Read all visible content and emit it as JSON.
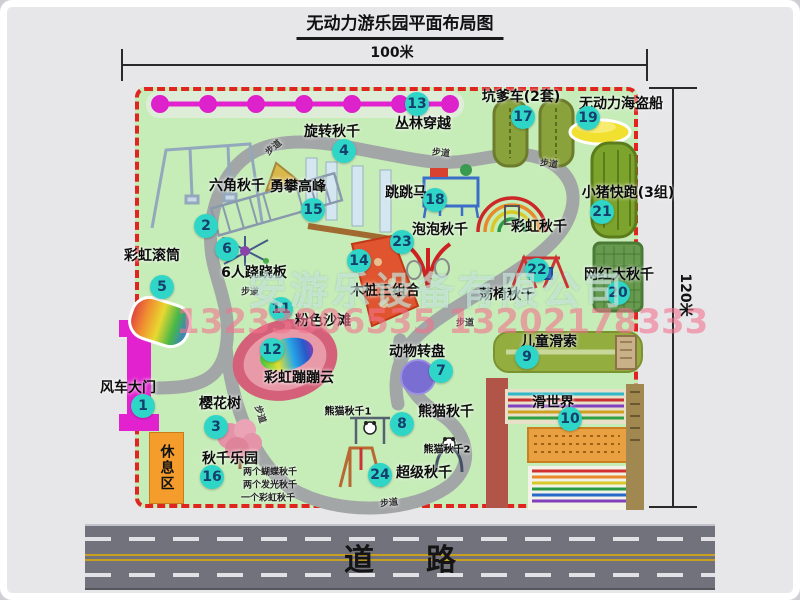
{
  "title": "无动力游乐园平面布局图",
  "dimensions": {
    "width": "100米",
    "height": "120米"
  },
  "road": {
    "label": "道路"
  },
  "rest_area": {
    "label": "休息区"
  },
  "watermark": {
    "company": "安游乐设备有限公司",
    "phone": "13233806535 13202178333"
  },
  "colors": {
    "map_green": "#c6ecb8",
    "border_red": "#e02420",
    "badge_teal": "#2fd6c8",
    "gate_magenta": "#e322cf",
    "rest_orange": "#f59d2c",
    "path_gray": "#a2a6a6"
  },
  "pois": [
    {
      "num": "1",
      "label": "风车大门",
      "bx": 143,
      "by": 406,
      "lx": 128,
      "ly": 387
    },
    {
      "num": "2",
      "label": "六角秋千",
      "bx": 206,
      "by": 226,
      "lx": 237,
      "ly": 185
    },
    {
      "num": "3",
      "label": "樱花树",
      "bx": 216,
      "by": 427,
      "lx": 220,
      "ly": 403
    },
    {
      "num": "4",
      "label": "旋转秋千",
      "bx": 344,
      "by": 151,
      "lx": 332,
      "ly": 131
    },
    {
      "num": "5",
      "label": "彩虹滚筒",
      "bx": 162,
      "by": 287,
      "lx": 152,
      "ly": 255
    },
    {
      "num": "6",
      "label": "6人跷跷板",
      "bx": 227,
      "by": 249,
      "lx": 254,
      "ly": 272
    },
    {
      "num": "7",
      "label": "动物转盘",
      "bx": 441,
      "by": 371,
      "lx": 417,
      "ly": 351
    },
    {
      "num": "8",
      "label": "熊猫秋千",
      "bx": 402,
      "by": 424,
      "lx": 446,
      "ly": 411
    },
    {
      "num": "9",
      "label": "儿童滑索",
      "bx": 527,
      "by": 357,
      "lx": 549,
      "ly": 341
    },
    {
      "num": "10",
      "label": "滑世界",
      "bx": 570,
      "by": 419,
      "lx": 553,
      "ly": 402
    },
    {
      "num": "11",
      "label": "粉色沙滩",
      "bx": 281,
      "by": 309,
      "lx": 323,
      "ly": 320
    },
    {
      "num": "12",
      "label": "彩虹蹦蹦云",
      "bx": 272,
      "by": 350,
      "lx": 299,
      "ly": 377
    },
    {
      "num": "13",
      "label": "丛林穿越",
      "bx": 417,
      "by": 104,
      "lx": 423,
      "ly": 123
    },
    {
      "num": "14",
      "label": "木桩三组合",
      "bx": 359,
      "by": 261,
      "lx": 385,
      "ly": 290
    },
    {
      "num": "15",
      "label": "勇攀高峰",
      "bx": 313,
      "by": 210,
      "lx": 298,
      "ly": 186
    },
    {
      "num": "16",
      "label": "秋千乐园",
      "bx": 212,
      "by": 477,
      "lx": 230,
      "ly": 458
    },
    {
      "num": "17",
      "label": "坑爹车(2套)",
      "bx": 523,
      "by": 117,
      "lx": 521,
      "ly": 96
    },
    {
      "num": "18",
      "label": "跳跳马",
      "bx": 435,
      "by": 200,
      "lx": 406,
      "ly": 192
    },
    {
      "num": "19",
      "label": "无动力海盗船",
      "bx": 588,
      "by": 118,
      "lx": 621,
      "ly": 103
    },
    {
      "num": "20",
      "label": "网红大秋千",
      "bx": 618,
      "by": 293,
      "lx": 619,
      "ly": 274
    },
    {
      "num": "21",
      "label": "小猪快跑(3组)",
      "bx": 602,
      "by": 212,
      "lx": 628,
      "ly": 192
    },
    {
      "num": "22",
      "label": "荡椅秋千",
      "bx": 537,
      "by": 270,
      "lx": 507,
      "ly": 294
    },
    {
      "num": "23",
      "label": "泡泡秋千",
      "bx": 402,
      "by": 242,
      "lx": 440,
      "ly": 229
    },
    {
      "num": "24",
      "label": "超级秋千",
      "bx": 380,
      "by": 475,
      "lx": 424,
      "ly": 472
    }
  ],
  "plain_labels": [
    {
      "label": "彩虹秋千",
      "x": 539,
      "y": 226
    },
    {
      "label": "熊猫秋千1",
      "x": 348,
      "y": 410,
      "cls": "small"
    },
    {
      "label": "熊猫秋千2",
      "x": 447,
      "y": 448,
      "cls": "small"
    },
    {
      "label": "两个蝴蝶秋千",
      "x": 270,
      "y": 471,
      "cls": "tiny"
    },
    {
      "label": "两个发光秋千",
      "x": 270,
      "y": 484,
      "cls": "tiny"
    },
    {
      "label": "一个彩虹秋千",
      "x": 268,
      "y": 497,
      "cls": "tiny"
    }
  ],
  "walkways": [
    {
      "label": "步道",
      "x": 273,
      "y": 147,
      "rot": -40
    },
    {
      "label": "步道",
      "x": 441,
      "y": 152,
      "rot": 6
    },
    {
      "label": "步道",
      "x": 549,
      "y": 163,
      "rot": 8
    },
    {
      "label": "步道",
      "x": 250,
      "y": 291,
      "rot": 0
    },
    {
      "label": "步道",
      "x": 465,
      "y": 322,
      "rot": 0
    },
    {
      "label": "步道",
      "x": 389,
      "y": 502,
      "rot": -6
    },
    {
      "label": "步道",
      "x": 261,
      "y": 414,
      "rot": 72
    }
  ]
}
